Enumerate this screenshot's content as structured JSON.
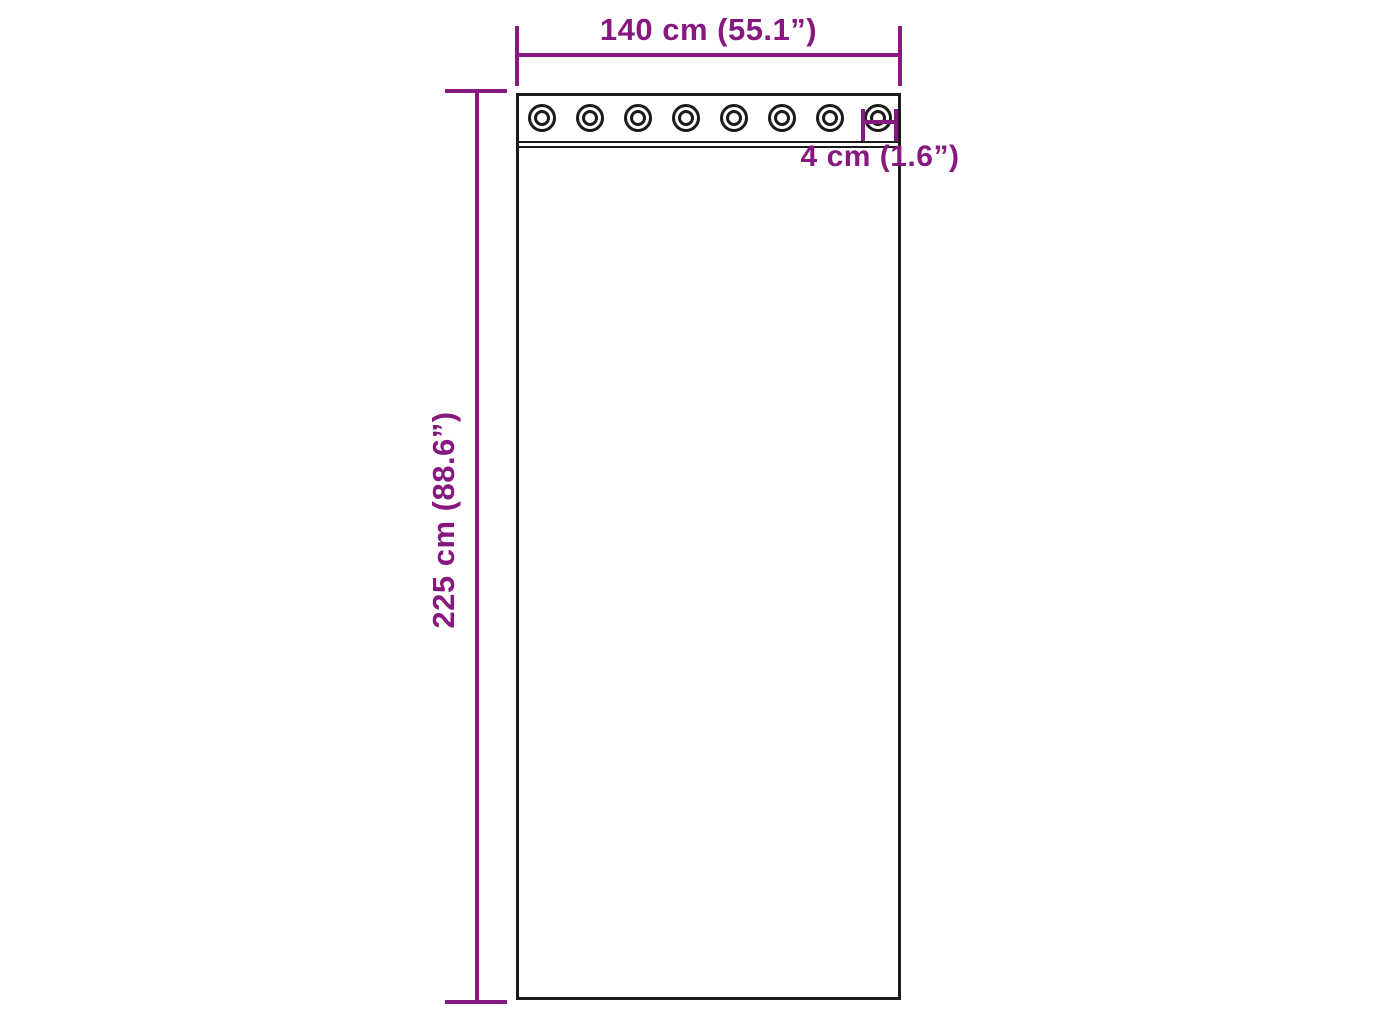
{
  "diagram": {
    "subject": "curtain-panel-with-grommets",
    "width_label": "140 cm (55.1”)",
    "height_label": "225 cm (88.6”)",
    "grommet_spacing_label": "4 cm (1.6”)",
    "grommet_count": 8,
    "colors": {
      "dimension": "#87187F",
      "outline": "#1A1A1A",
      "background": "#FFFFFF"
    }
  }
}
